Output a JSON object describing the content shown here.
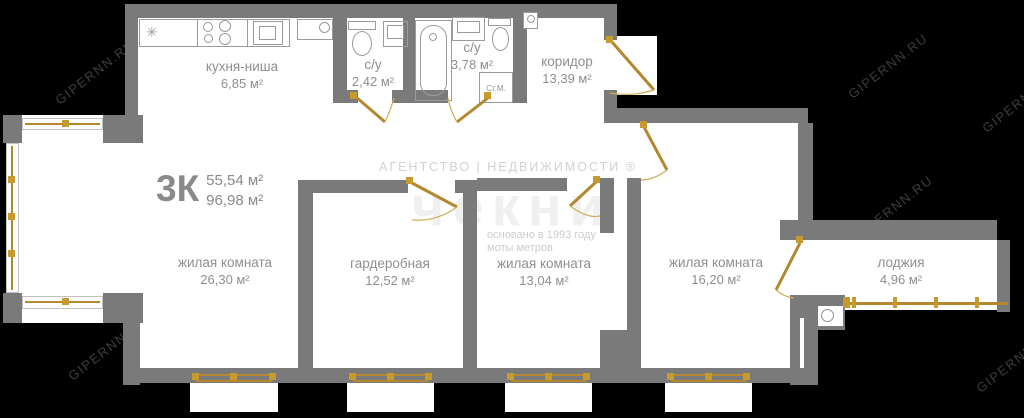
{
  "plan": {
    "type_label": "3К",
    "area_living": "55,54 м²",
    "area_total": "96,98 м²"
  },
  "rooms": {
    "kitchen": {
      "name": "кухня-ниша",
      "area": "6,85 м²"
    },
    "bath_small": {
      "name": "с/у",
      "area": "2,42 м²"
    },
    "bath_big": {
      "name": "с/у",
      "area": "3,78 м²"
    },
    "corridor": {
      "name": "коридор",
      "area": "13,39 м²"
    },
    "living1": {
      "name": "жилая комната",
      "area": "26,30 м²"
    },
    "wardrobe": {
      "name": "гардеробная",
      "area": "12,52 м²"
    },
    "living2": {
      "name": "жилая комната",
      "area": "13,04 м²"
    },
    "living3": {
      "name": "жилая комната",
      "area": "16,20 м²"
    },
    "loggia": {
      "name": "лоджия",
      "area": "4,96 м²"
    }
  },
  "fixtures": {
    "washing_machine": "Ст.М."
  },
  "watermarks": {
    "site": "GIPERNN.RU",
    "agency_line": "АГЕНТСТВО | НЕДВИЖИМОСТИ ®",
    "agency_logo": "чекни",
    "founded": "основано в 1993 году",
    "slogan": "моты метров"
  },
  "colors": {
    "background": "#000000",
    "wall": "#7a7a7a",
    "floor": "#ffffff",
    "gold": "#b3882e",
    "gold_bright": "#c79a2f",
    "label_text": "#8f8f8f",
    "site_watermark": "#3d3d3d"
  }
}
